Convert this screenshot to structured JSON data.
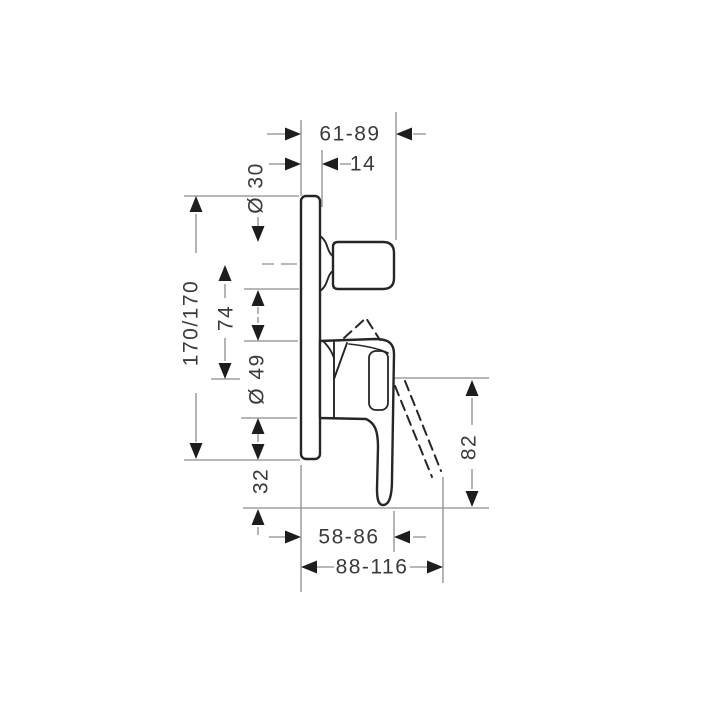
{
  "drawing": {
    "title": "concealed single-lever mixer side elevation",
    "dimensions": {
      "top": [
        {
          "id": "depth-range-total",
          "label": "61-89"
        },
        {
          "id": "plate-depth",
          "label": "14"
        }
      ],
      "left": [
        {
          "id": "knob-diameter",
          "label": "Ø 30"
        },
        {
          "id": "plate-height",
          "label": "170/170"
        },
        {
          "id": "axis-distance",
          "label": "74"
        },
        {
          "id": "lever-hub-diameter",
          "label": "Ø 49"
        },
        {
          "id": "lower-offset",
          "label": "32"
        },
        {
          "id": "lever-length",
          "label": "82"
        }
      ],
      "bottom": [
        {
          "id": "lever-projection-range",
          "label": "58-86"
        },
        {
          "id": "lever-swung-projection-range",
          "label": "88-116"
        }
      ]
    },
    "colors": {
      "ink": "#262626",
      "dimension_line": "#8c8c8c",
      "label_text": "#3a3a3a",
      "background": "#ffffff"
    }
  }
}
